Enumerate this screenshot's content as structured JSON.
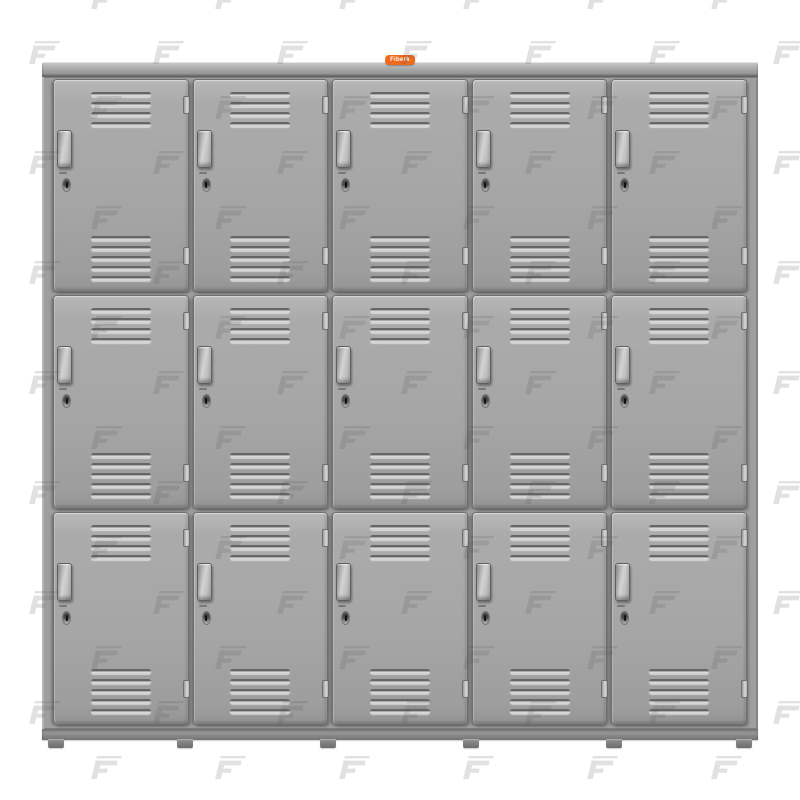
{
  "meta": {
    "description": "Product photo of a gray steel locker cabinet: five columns, three tiers, fifteen vented doors on a white watermarked background"
  },
  "badge": {
    "label": "Fiberk",
    "bg_color": "#ED6A1F",
    "text_color": "#FFFFFF"
  },
  "locker": {
    "columns": 5,
    "tiers": 3,
    "door_count": 15,
    "top_vent_slots": 4,
    "bottom_vent_slots": 5,
    "hinges_per_door": 2,
    "feet_count": 6,
    "colors": {
      "door_face": "#A6A6A6",
      "frame": "#9F9F9F",
      "gap_shadow": "#5F5F5F",
      "vent_highlight": "#DFDFDF",
      "vent_shadow": "#666666",
      "handle": "#C9C9C9",
      "base_rail": "#888888"
    }
  },
  "watermark": {
    "glyph": "F",
    "color": "#555555",
    "opacity": 0.17
  },
  "background_color": "#FFFFFF"
}
